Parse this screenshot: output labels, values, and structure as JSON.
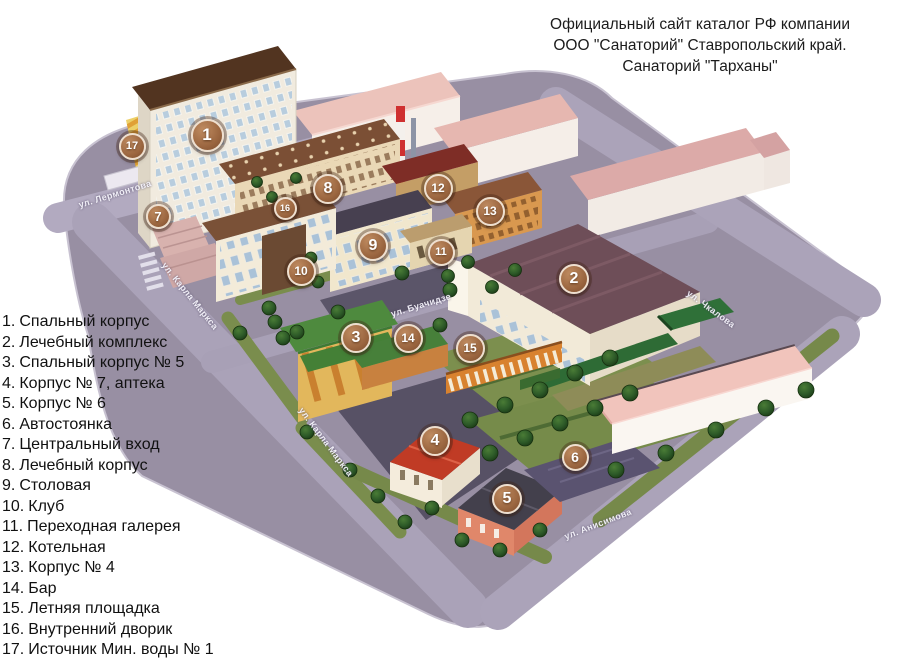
{
  "title": {
    "line1": "Официальный сайт каталог РФ компании",
    "line2": "ООО \"Санаторий\" Ставропольский край.",
    "line3": "Санаторий \"Тарханы\""
  },
  "legend": {
    "items": [
      {
        "num": "1.",
        "label": "Спальный корпус"
      },
      {
        "num": "2.",
        "label": "Лечебный комплекс"
      },
      {
        "num": "3.",
        "label": "Спальный корпус № 5"
      },
      {
        "num": "4.",
        "label": "Корпус № 7, аптека"
      },
      {
        "num": "5.",
        "label": "Корпус № 6"
      },
      {
        "num": "6.",
        "label": "Автостоянка"
      },
      {
        "num": "7.",
        "label": "Центральный вход"
      },
      {
        "num": "8.",
        "label": "Лечебный корпус"
      },
      {
        "num": "9.",
        "label": "Столовая"
      },
      {
        "num": "10.",
        "label": "Клуб"
      },
      {
        "num": "11.",
        "label": "Переходная галерея"
      },
      {
        "num": "12.",
        "label": "Котельная"
      },
      {
        "num": "13.",
        "label": "Корпус № 4"
      },
      {
        "num": "14.",
        "label": "Бар"
      },
      {
        "num": "15.",
        "label": "Летняя площадка"
      },
      {
        "num": "16.",
        "label": "Внутренний дворик"
      },
      {
        "num": "17.",
        "label": "Источник Мин. воды № 1"
      }
    ]
  },
  "map": {
    "markers": [
      {
        "n": "1",
        "x": 205,
        "y": 133,
        "s": 29
      },
      {
        "n": "2",
        "x": 572,
        "y": 277,
        "s": 26
      },
      {
        "n": "3",
        "x": 354,
        "y": 336,
        "s": 26
      },
      {
        "n": "4",
        "x": 433,
        "y": 439,
        "s": 26
      },
      {
        "n": "5",
        "x": 505,
        "y": 497,
        "s": 26
      },
      {
        "n": "6",
        "x": 573,
        "y": 455,
        "s": 23
      },
      {
        "n": "7",
        "x": 156,
        "y": 214,
        "s": 21
      },
      {
        "n": "8",
        "x": 326,
        "y": 187,
        "s": 26
      },
      {
        "n": "9",
        "x": 371,
        "y": 244,
        "s": 26
      },
      {
        "n": "10",
        "x": 299,
        "y": 269,
        "s": 25
      },
      {
        "n": "11",
        "x": 439,
        "y": 250,
        "s": 23
      },
      {
        "n": "12",
        "x": 436,
        "y": 186,
        "s": 25
      },
      {
        "n": "13",
        "x": 488,
        "y": 209,
        "s": 25
      },
      {
        "n": "14",
        "x": 406,
        "y": 336,
        "s": 25
      },
      {
        "n": "15",
        "x": 468,
        "y": 346,
        "s": 25
      },
      {
        "n": "16",
        "x": 283,
        "y": 206,
        "s": 19
      },
      {
        "n": "17",
        "x": 130,
        "y": 144,
        "s": 23
      }
    ],
    "streets": [
      {
        "name": "ул. Лермонтова",
        "x": 115,
        "y": 194,
        "rot": -17
      },
      {
        "name": "ул. Карла Маркса",
        "x": 190,
        "y": 296,
        "rot": 51
      },
      {
        "name": "ул. Буачидзе",
        "x": 421,
        "y": 305,
        "rot": -17
      },
      {
        "name": "ул. Карла Маркса",
        "x": 326,
        "y": 442,
        "rot": 53
      },
      {
        "name": "ул. Чкалова",
        "x": 711,
        "y": 309,
        "rot": 36
      },
      {
        "name": "ул. Анисимова",
        "x": 598,
        "y": 524,
        "rot": -21
      }
    ],
    "colors": {
      "marker_fill": "#9a653f",
      "marker_ring": "#eedfcf",
      "ground": "#958ca1",
      "street": "#aba3b9",
      "park_green": "#7c8f4e",
      "tree_green": "#2d5a28",
      "roof_brown": "#523420",
      "roof_pink": "#ecc3bb",
      "roof_maroon": "#6e4e58",
      "roof_green": "#4e8a3e",
      "roof_red": "#c03b25",
      "building_cream": "#f2ead8",
      "accent_orange": "#d8853f",
      "chimney_red": "#cf3030"
    }
  }
}
